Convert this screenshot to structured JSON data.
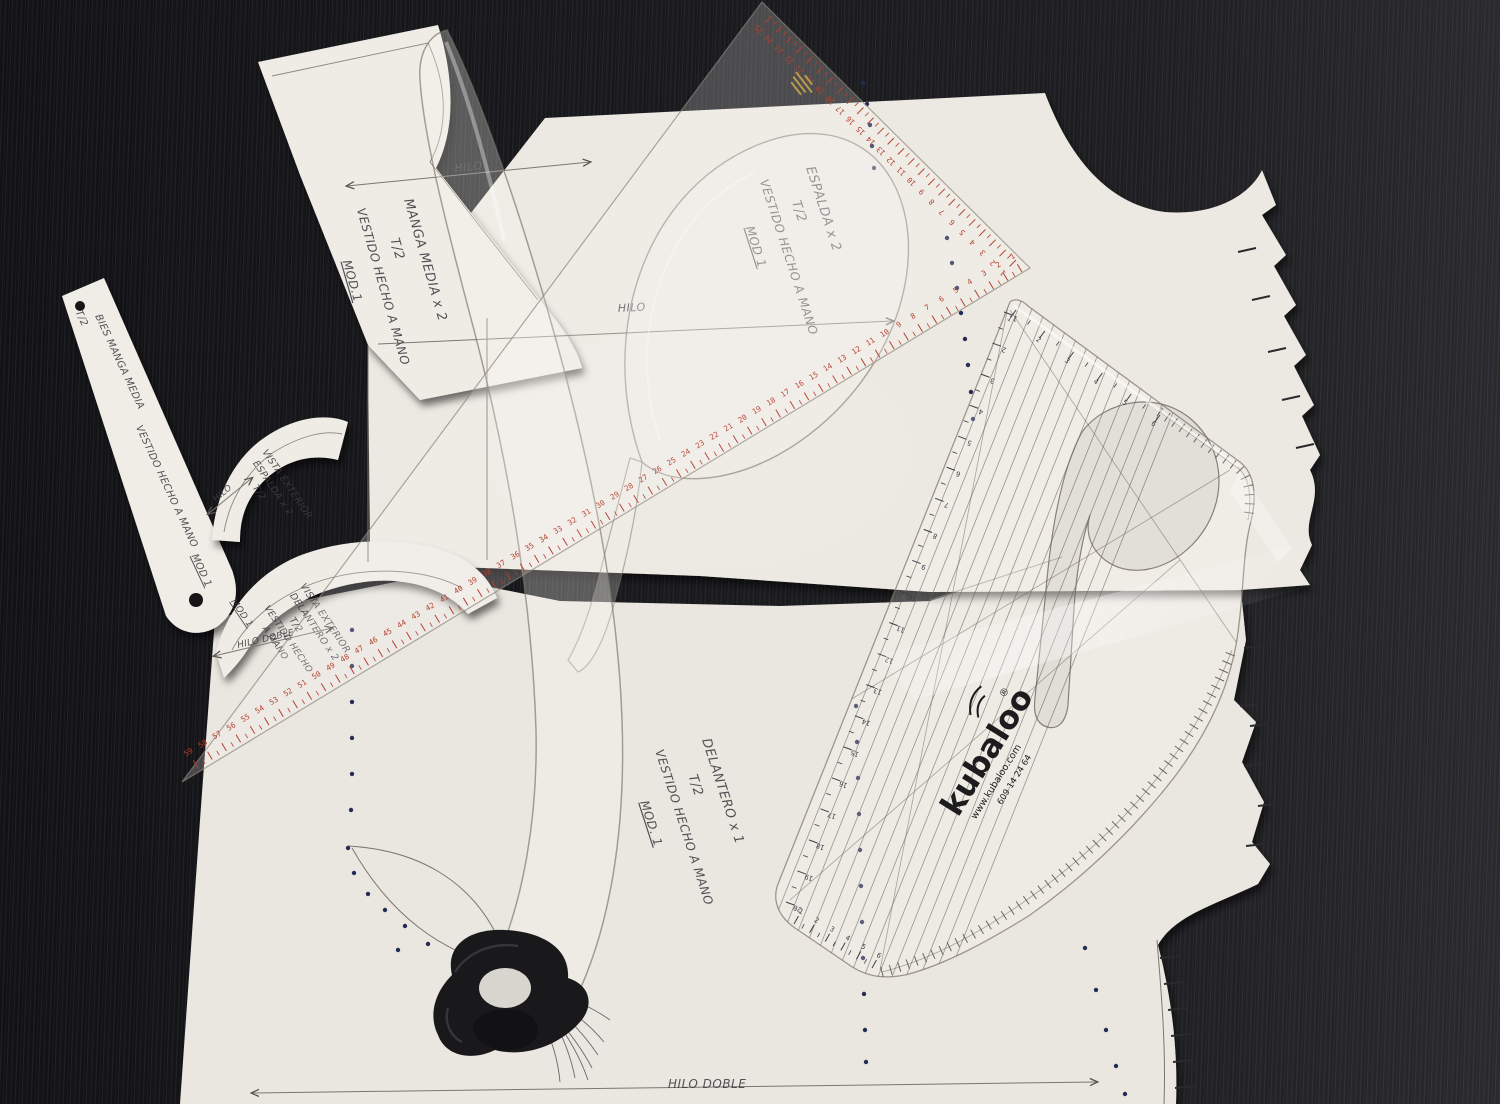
{
  "labels": {
    "hilo": "HILO",
    "hilo_doble": "HILO DOBLE"
  },
  "pieces": {
    "manga": {
      "lines": [
        "MANGA MEDIA x 2",
        "T/2",
        "VESTIDO HECHO A MANO",
        "MOD.1"
      ]
    },
    "espalda": {
      "lines": [
        "ESPALDA x 2",
        "T/2",
        "VESTIDO HECHO A MANO",
        "MOD 1"
      ]
    },
    "bies": {
      "lines": [
        "BIES MANGA MEDIA",
        "T/2",
        "VESTIDO HECHO A MANO",
        "MOD 1"
      ]
    },
    "vista_espalda": {
      "lines": [
        "VISTA EXTERIOR",
        "ESPALDA x 2",
        "T/2"
      ]
    },
    "vista_delantero": {
      "lines": [
        "VISTA EXTERIOR",
        "DELANTERO x 2",
        "T/2",
        "VESTIDO HECHO",
        "A MANO",
        "MOD 1"
      ]
    },
    "delantero": {
      "lines": [
        "DELANTERO x 1",
        "T/2",
        "VESTIDO HECHO A MANO",
        "MOD. 1"
      ]
    }
  },
  "rulers": {
    "triangle": {
      "hypotenuse_numbers": [
        1,
        2,
        3,
        4,
        5,
        6,
        7,
        8,
        9,
        10,
        11,
        12,
        13,
        14,
        15,
        16,
        17,
        18,
        19,
        20,
        21,
        22,
        23,
        24,
        25,
        26,
        27,
        28,
        29,
        30,
        31,
        32,
        33,
        34,
        35,
        36,
        37,
        38,
        39,
        40,
        41,
        42,
        43,
        44,
        45,
        46,
        47,
        48,
        49,
        50,
        51,
        52,
        53,
        54,
        55,
        56,
        57,
        58,
        59
      ],
      "leg_numbers": [
        25,
        24,
        23,
        22,
        21,
        20,
        19,
        18,
        17,
        16,
        15,
        14,
        13,
        12,
        11,
        10,
        9,
        8,
        7,
        6,
        5,
        4,
        3,
        2,
        1
      ]
    },
    "kubaloo": {
      "brand": "kubaloo",
      "reg": "®",
      "site": "www.kubaloo.com",
      "phone": "609 14 24 64",
      "top_numbers": [
        1,
        2,
        3,
        4,
        5,
        6
      ],
      "left_numbers": [
        1,
        2,
        3,
        4,
        5,
        6,
        7,
        8,
        9,
        10,
        11,
        12,
        13,
        14,
        15,
        16,
        17,
        18,
        19,
        20
      ],
      "bottom_numbers": [
        1,
        2,
        3,
        4,
        5,
        6
      ]
    }
  },
  "colors": {
    "table": "#131316",
    "paper": "#ece9e2",
    "paper_alt": "#e9e6df",
    "ruler_scale_red": "#b5402e",
    "kubaloo_number": "#3c3f48",
    "ink": "#3b3b40",
    "dot_blue": "#232c55",
    "gold": "#b89a4e",
    "edge_tick": "#2a2a2e"
  }
}
